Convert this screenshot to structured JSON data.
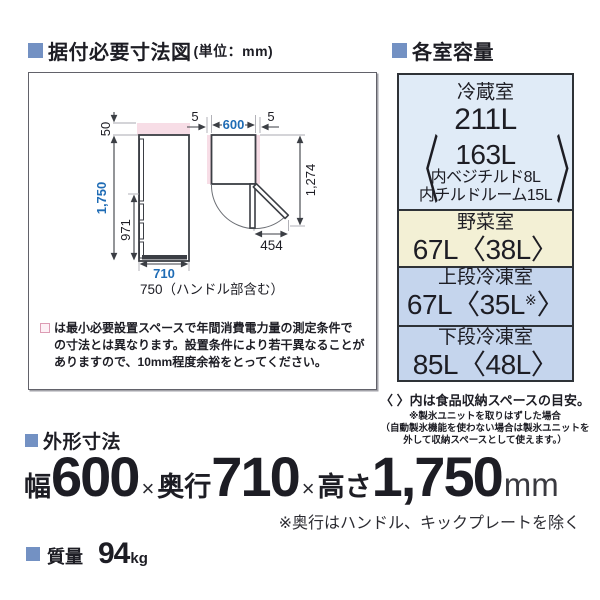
{
  "colors": {
    "accent_square": "#7391c3",
    "dimension_blue": "#1f6cb5",
    "clearance_pink": "#f7dde6",
    "table_refrigerator_bg": "#e0ebf7",
    "table_vegetable_bg": "#f3f0d5",
    "table_freezer_bg": "#c5d5ed",
    "table_border": "#2e3237"
  },
  "install_section": {
    "title": "据付必要寸法図",
    "unit_label": "(単位：mm)",
    "diagram": {
      "dim_top_clearance": "50",
      "dim_height": "1,750",
      "dim_handle_height": "971",
      "dim_depth": "710",
      "dim_depth_with_handle": "750（ハンドル部含む）",
      "dim_side_clearance_left": "5",
      "dim_side_clearance_right": "5",
      "dim_width": "600",
      "dim_open_depth": "1,274",
      "dim_door_open": "454"
    },
    "note_symbol": "□",
    "note_lines": [
      "は最小必要設置スペースで年間消費電力量の測定条件で",
      "の寸法とは異なります。設置条件により若干異なることが",
      "ありますので、10mm程度余裕をとってください。"
    ]
  },
  "capacity_section": {
    "title": "各室容量",
    "rows": [
      {
        "name": "冷蔵室",
        "value": "211L",
        "bracket_open": "〈",
        "bracket_close": "〉",
        "sub": [
          "163L",
          "内ベジチルド8L",
          "内チルドルーム15L"
        ]
      },
      {
        "name": "野菜室",
        "value": "67L〈38L〉"
      },
      {
        "name": "上段冷凍室",
        "value_main": "67L〈35L",
        "value_sup": "※",
        "value_close": "〉"
      },
      {
        "name": "下段冷凍室",
        "value": "85L〈48L〉"
      }
    ],
    "note_main": "〈 〉内は食品収納スペースの目安。",
    "note_sub": [
      "※製氷ユニットを取りはずした場合",
      "（自動製氷機能を使わない場合は製氷ユニットを",
      "外して収納スペースとして使えます。）"
    ]
  },
  "external_dimensions_section": {
    "title": "外形寸法",
    "width_label": "幅",
    "width_value": "600",
    "multiply_1": "×",
    "depth_label": "奥行",
    "depth_value": "710",
    "multiply_2": "×",
    "height_label": "高さ",
    "height_value": "1,750",
    "unit": "mm",
    "note": "※奥行はハンドル、キックプレートを除く"
  },
  "weight_section": {
    "title": "質量",
    "value": "94",
    "unit": "kg"
  }
}
